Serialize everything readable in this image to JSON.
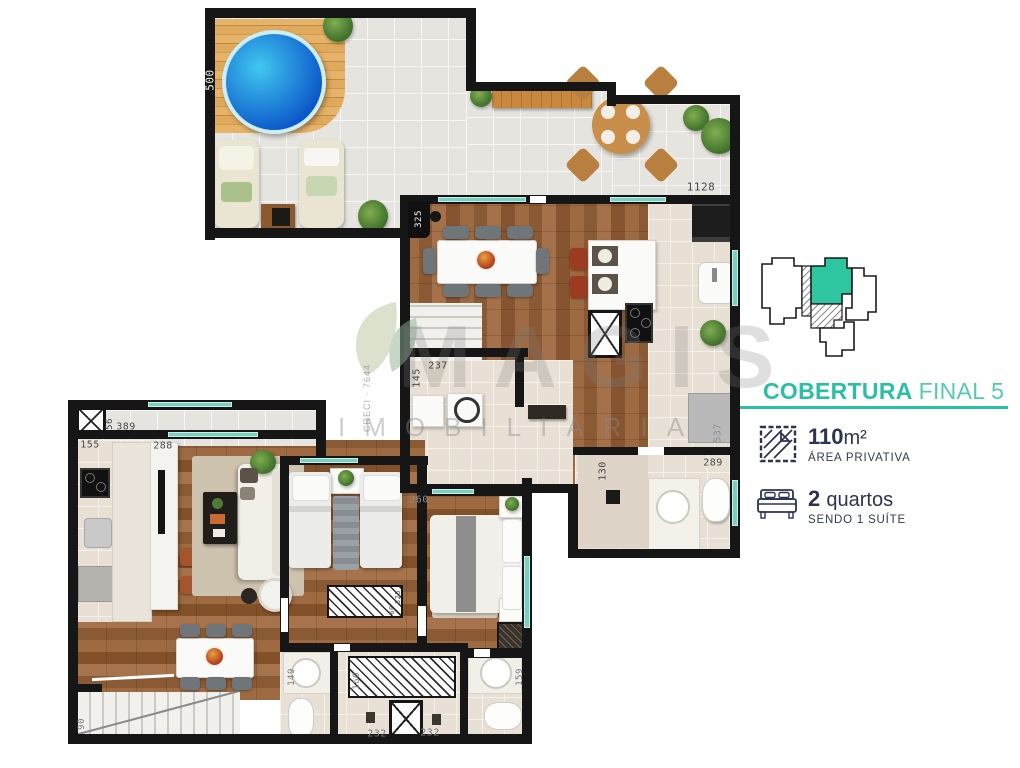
{
  "colors": {
    "accent_teal": "#2bbfa5",
    "accent_teal_light": "#52cab4",
    "navy_text": "#2b3450",
    "wall_black": "#161616",
    "unit_highlight": "#2ec6a0",
    "window_teal": "#79cfc0",
    "pool_blue": "#0d59cc"
  },
  "sidebar": {
    "title": {
      "bold": "COBERTURA",
      "regular": "FINAL 5"
    },
    "specs": [
      {
        "icon": "area-hatch-icon",
        "value": "110",
        "unit": "m²",
        "sub": "ÁREA PRIVATIVA"
      },
      {
        "icon": "bed-icon",
        "value": "2",
        "unit": "quartos",
        "sub": "SENDO 1 SUÍTE"
      }
    ]
  },
  "watermark": {
    "logo_icon": "leaf-logo-icon",
    "crec": "CRECI · 7644",
    "brand": "MAGIS",
    "sub": "IMOBILIÁRIA"
  },
  "dimension_labels": [
    {
      "text": "500",
      "x": 210,
      "y": 80,
      "rot": -90,
      "color": "#f2f2f2",
      "size": 11
    },
    {
      "text": "1128",
      "x": 701,
      "y": 187,
      "rot": 0,
      "color": "#4a4a4a",
      "size": 11
    },
    {
      "text": "325",
      "x": 419,
      "y": 219,
      "rot": -90,
      "color": "#f2f2f2",
      "size": 9
    },
    {
      "text": "237",
      "x": 438,
      "y": 366,
      "rot": 0,
      "color": "#4a4a4a",
      "size": 10
    },
    {
      "text": "145",
      "x": 417,
      "y": 378,
      "rot": -90,
      "color": "#4a4a4a",
      "size": 10
    },
    {
      "text": "537",
      "x": 718,
      "y": 433,
      "rot": -90,
      "color": "#8d8d8d",
      "size": 10
    },
    {
      "text": "289",
      "x": 713,
      "y": 463,
      "rot": 0,
      "color": "#4a4a4a",
      "size": 10
    },
    {
      "text": "130",
      "x": 603,
      "y": 471,
      "rot": -90,
      "color": "#4a4a4a",
      "size": 10
    },
    {
      "text": "56",
      "x": 110,
      "y": 424,
      "rot": -90,
      "color": "#4a4a4a",
      "size": 9
    },
    {
      "text": "389",
      "x": 126,
      "y": 427,
      "rot": 0,
      "color": "#4a4a4a",
      "size": 10
    },
    {
      "text": "155",
      "x": 90,
      "y": 445,
      "rot": 0,
      "color": "#4a4a4a",
      "size": 10
    },
    {
      "text": "288",
      "x": 163,
      "y": 446,
      "rot": 0,
      "color": "#4a4a4a",
      "size": 10
    },
    {
      "text": "260",
      "x": 419,
      "y": 500,
      "rot": 0,
      "color": "#8d8d8d",
      "size": 10
    },
    {
      "text": "325",
      "x": 398,
      "y": 597,
      "rot": -90,
      "color": "#4a4a4a",
      "size": 7
    },
    {
      "text": "60",
      "x": 392,
      "y": 610,
      "rot": -90,
      "color": "#4a4a4a",
      "size": 7
    },
    {
      "text": "149",
      "x": 292,
      "y": 677,
      "rot": -90,
      "color": "#7a7a7a",
      "size": 9
    },
    {
      "text": "160",
      "x": 357,
      "y": 681,
      "rot": -90,
      "color": "#7a7a7a",
      "size": 9
    },
    {
      "text": "159",
      "x": 520,
      "y": 677,
      "rot": -90,
      "color": "#7a7a7a",
      "size": 9
    },
    {
      "text": "232",
      "x": 377,
      "y": 734,
      "rot": 0,
      "color": "#7a7a7a",
      "size": 10
    },
    {
      "text": "232",
      "x": 430,
      "y": 733,
      "rot": 0,
      "color": "#7a7a7a",
      "size": 10
    },
    {
      "text": "90",
      "x": 82,
      "y": 724,
      "rot": -90,
      "color": "#7a7a7a",
      "size": 9
    }
  ]
}
